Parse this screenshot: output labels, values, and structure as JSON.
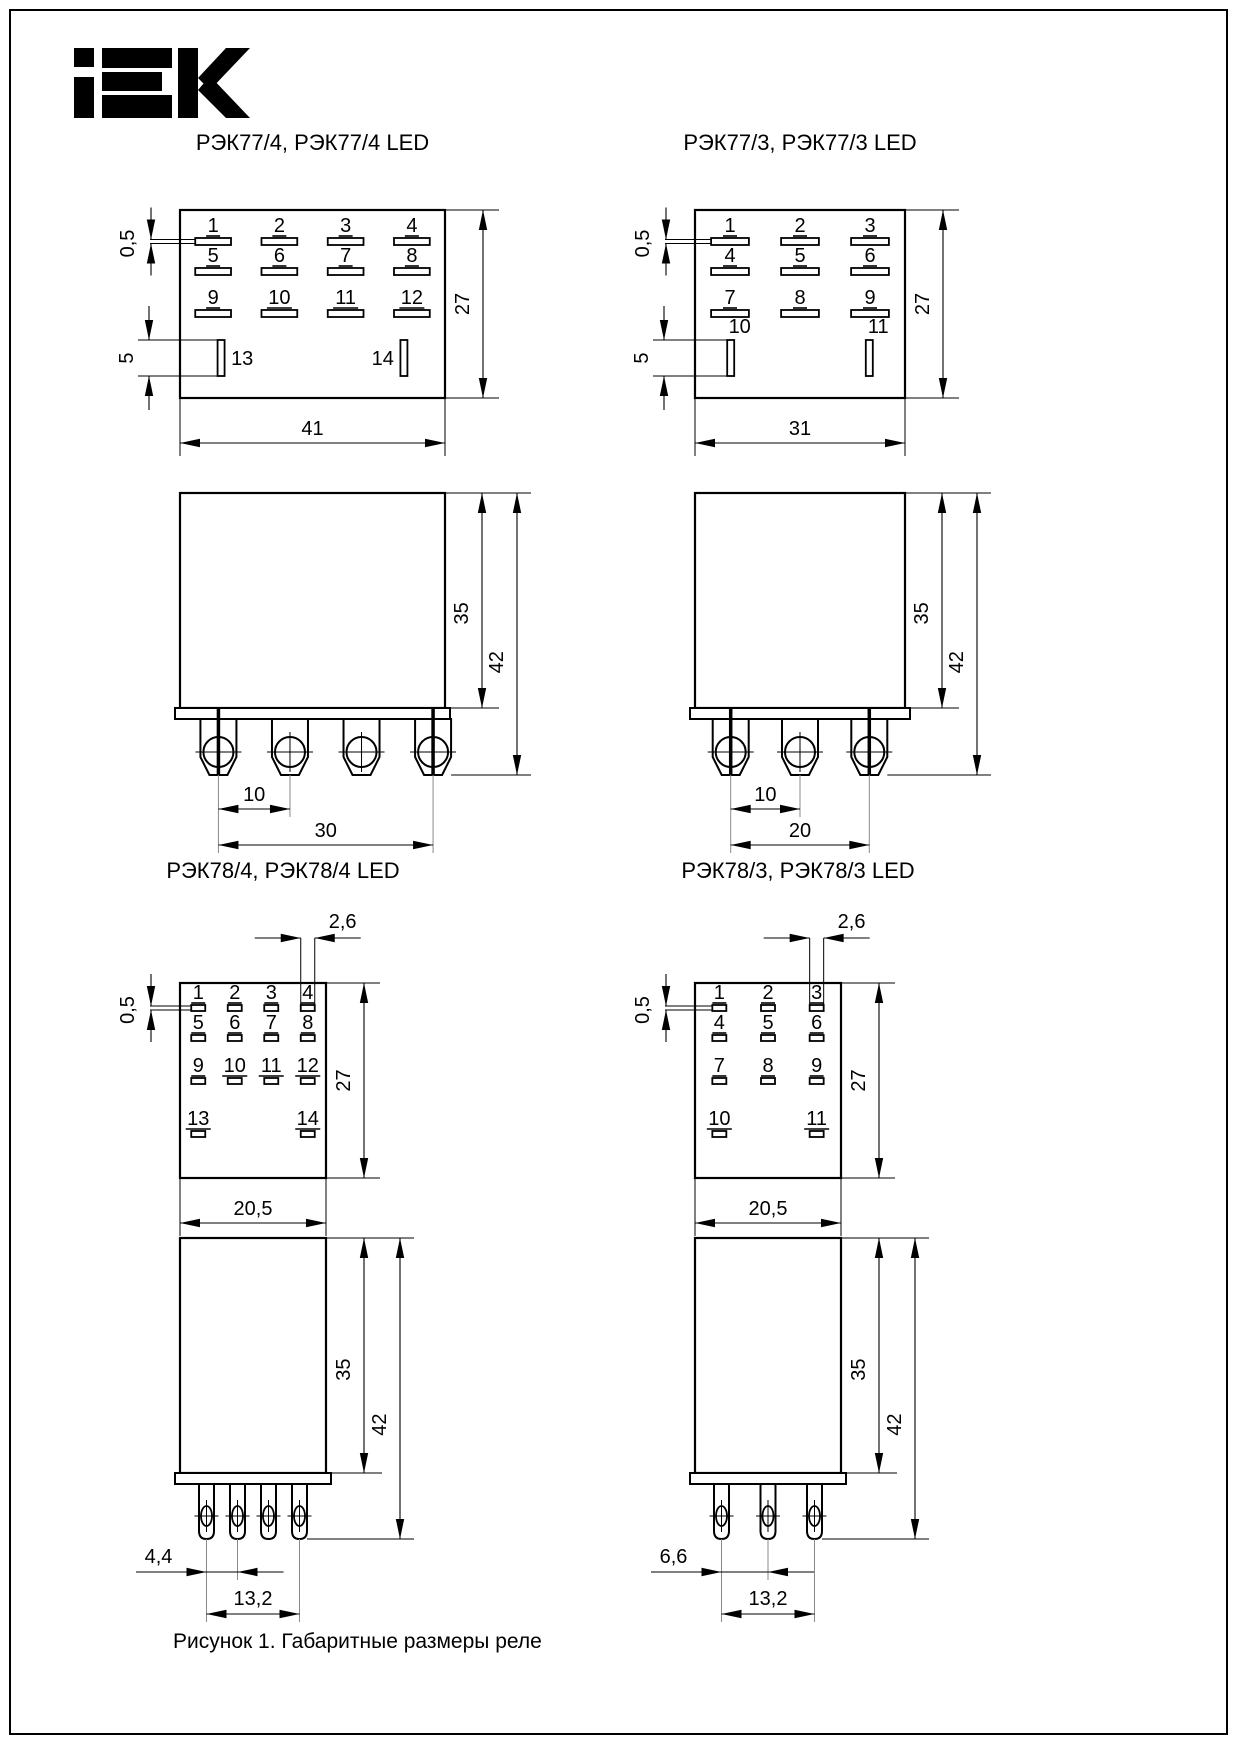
{
  "brand_logo": "IEK",
  "caption": "Рисунок 1. Габаритные размеры реле",
  "figures": [
    {
      "id": "rek77-4",
      "title": "РЭК77/4, РЭК77/4 LED",
      "series": "77",
      "columns": 4,
      "terminals": 4,
      "pin_rows": [
        [
          "1",
          "2",
          "3",
          "4"
        ],
        [
          "5",
          "6",
          "7",
          "8"
        ],
        [
          "9",
          "10",
          "11",
          "12"
        ]
      ],
      "bottom_pins": {
        "labels": [
          "13",
          "14"
        ],
        "columns": [
          0,
          3
        ]
      },
      "dims": {
        "pin_thickness": "0,5",
        "bottom_pin_length": "5",
        "front_height": "27",
        "front_width": "41",
        "body_height": "35",
        "total_height": "42",
        "terminal_pitch": "10",
        "terminal_span": "30"
      }
    },
    {
      "id": "rek77-3",
      "title": "РЭК77/3, РЭК77/3 LED",
      "series": "77",
      "columns": 3,
      "terminals": 3,
      "pin_rows": [
        [
          "1",
          "2",
          "3"
        ],
        [
          "4",
          "5",
          "6"
        ],
        [
          "7",
          "8",
          "9"
        ]
      ],
      "bottom_pins": {
        "labels": [
          "10",
          "11"
        ],
        "columns": [
          0,
          2
        ]
      },
      "dims": {
        "pin_thickness": "0,5",
        "bottom_pin_length": "5",
        "front_height": "27",
        "front_width": "31",
        "body_height": "35",
        "total_height": "42",
        "terminal_pitch": "10",
        "terminal_span": "20"
      }
    },
    {
      "id": "rek78-4",
      "title": "РЭК78/4, РЭК78/4 LED",
      "series": "78",
      "columns": 4,
      "terminals": 4,
      "pin_rows": [
        [
          "1",
          "2",
          "3",
          "4"
        ],
        [
          "5",
          "6",
          "7",
          "8"
        ],
        [
          "9",
          "10",
          "11",
          "12"
        ]
      ],
      "bottom_pins": {
        "labels": [
          "13",
          "14"
        ],
        "columns": [
          0,
          3
        ]
      },
      "dims": {
        "pin_thickness": "0,5",
        "pin_width": "2,6",
        "front_height": "27",
        "front_width": "20,5",
        "body_height": "35",
        "total_height": "42",
        "terminal_pitch": "4,4",
        "terminal_span": "13,2"
      }
    },
    {
      "id": "rek78-3",
      "title": "РЭК78/3, РЭК78/3 LED",
      "series": "78",
      "columns": 3,
      "terminals": 3,
      "pin_rows": [
        [
          "1",
          "2",
          "3"
        ],
        [
          "4",
          "5",
          "6"
        ],
        [
          "7",
          "8",
          "9"
        ]
      ],
      "bottom_pins": {
        "labels": [
          "10",
          "11"
        ],
        "columns": [
          0,
          2
        ]
      },
      "dims": {
        "pin_thickness": "0,5",
        "pin_width": "2,6",
        "front_height": "27",
        "front_width": "20,5",
        "body_height": "35",
        "total_height": "42",
        "terminal_pitch": "6,6",
        "terminal_span": "13,2"
      }
    }
  ]
}
